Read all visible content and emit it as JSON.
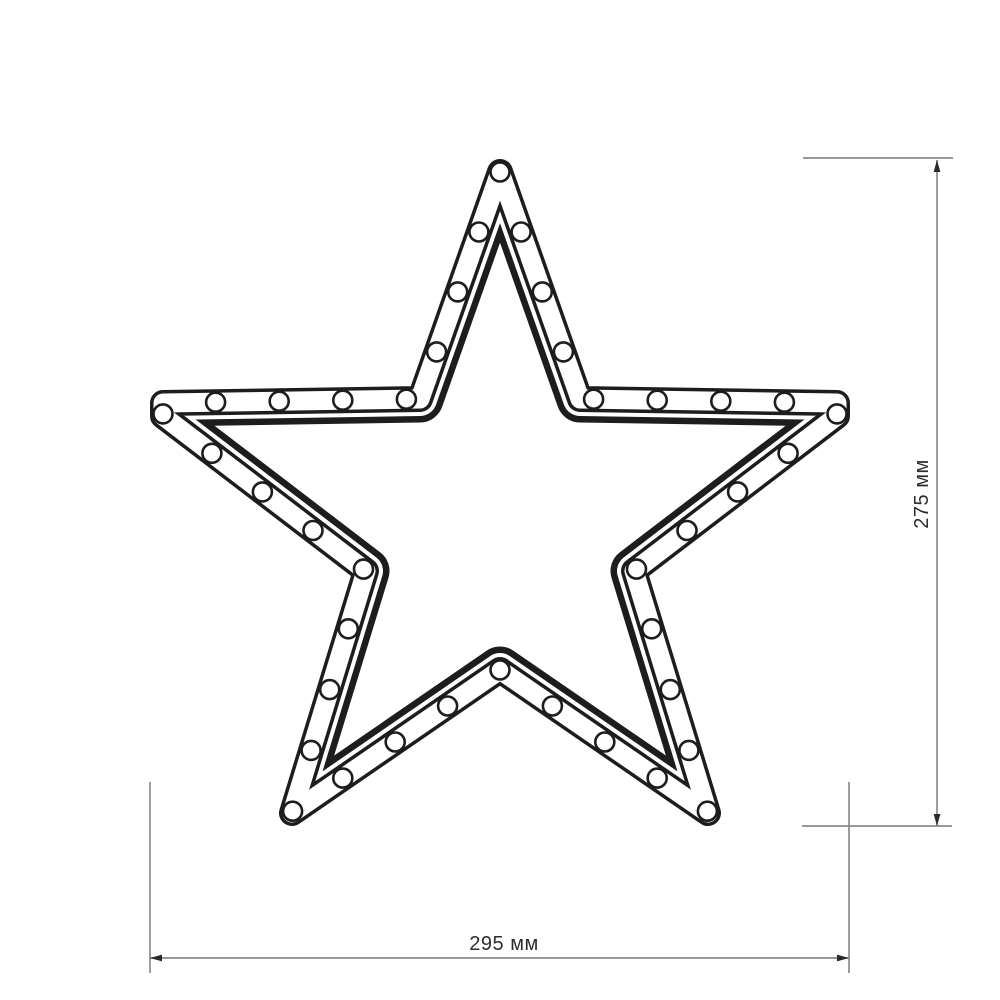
{
  "figure": {
    "type": "technical-drawing",
    "subject": "five-pointed LED star frame with bulb circles along the tube channel",
    "colors": {
      "ink": "#1d1d1d",
      "dimension_line": "#8a8a8a",
      "arrow": "#2a2a2a",
      "dimension_text": "#2d2d2d",
      "background": "#ffffff"
    },
    "star": {
      "outline_points": [
        [
          500,
          172
        ],
        [
          580,
          399
        ],
        [
          837,
          403
        ],
        [
          837,
          416
        ],
        [
          634,
          571
        ],
        [
          708,
          813
        ],
        [
          500,
          670
        ],
        [
          292,
          813
        ],
        [
          366,
          571
        ],
        [
          163,
          416
        ],
        [
          163,
          403
        ],
        [
          420,
          399
        ]
      ],
      "tube": {
        "inner_band_width": 47,
        "inner_gap_width": 34,
        "tube_width": 26,
        "channel_width": 19
      },
      "leds": {
        "count": 40,
        "radius": 9.5,
        "stroke_width": 2.6
      }
    },
    "dimensions": {
      "vertical": {
        "label": "275 мм",
        "line": {
          "x": 937,
          "y1": 160,
          "y2": 826
        },
        "extensions": [
          [
            803,
            158,
            953,
            158
          ],
          [
            802,
            826,
            952,
            826
          ]
        ],
        "label_pos": {
          "x": 928,
          "y": 494
        },
        "rotation": -90
      },
      "horizontal": {
        "label": "295 мм",
        "line": {
          "y": 958,
          "x1": 150,
          "x2": 849
        },
        "extensions": [
          [
            150,
            782,
            150,
            973
          ],
          [
            849,
            782,
            849,
            973
          ]
        ],
        "label_pos": {
          "x": 504,
          "y": 950
        }
      }
    }
  }
}
